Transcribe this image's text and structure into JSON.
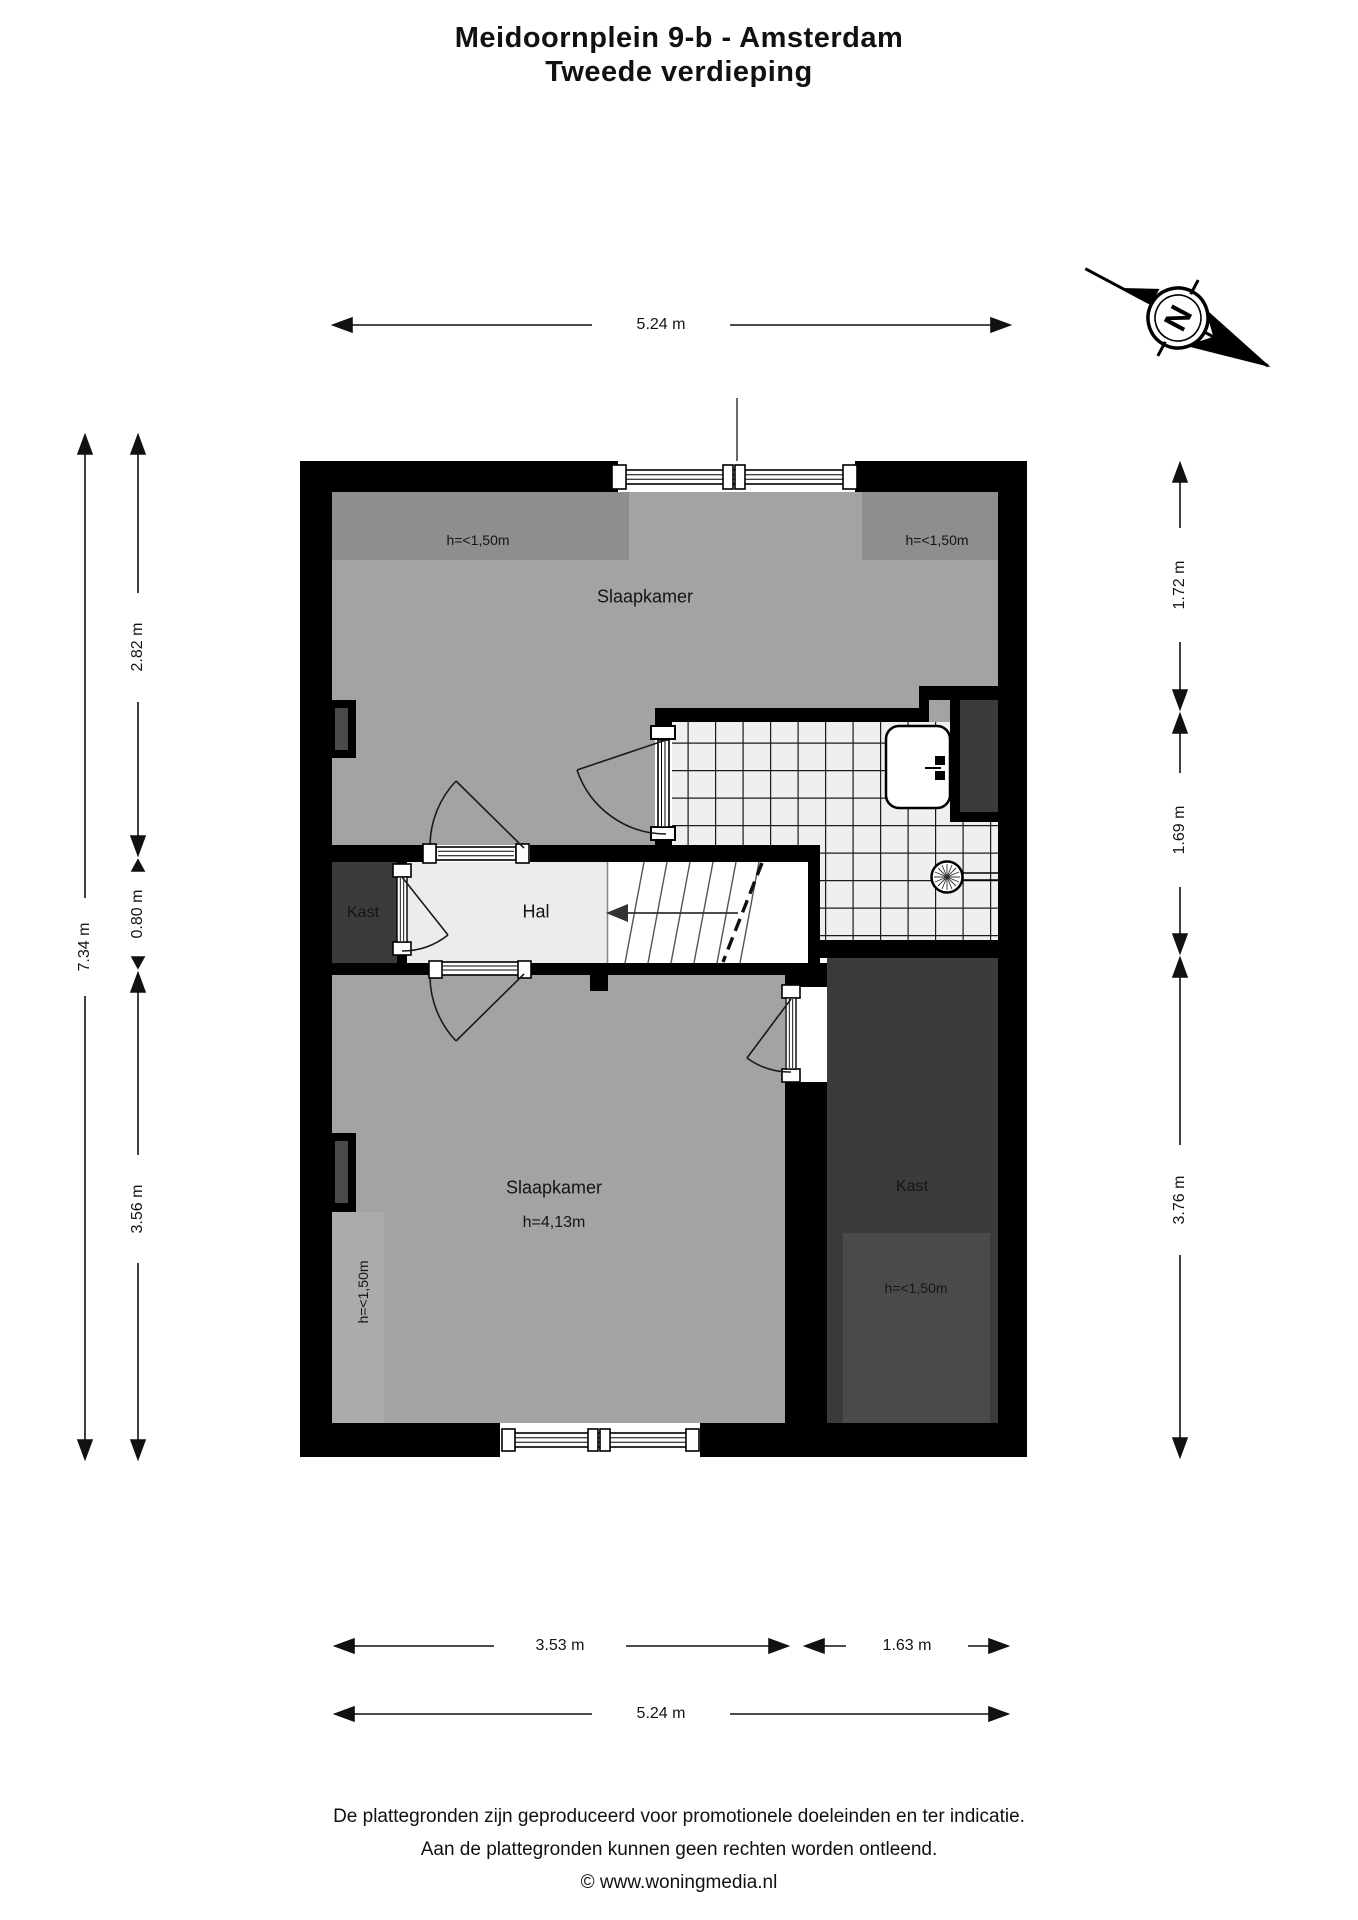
{
  "title": {
    "line1": "Meidoornplein 9-b - Amsterdam",
    "line2": "Tweede verdieping"
  },
  "compass": {
    "north_label": "N"
  },
  "plan": {
    "rooms": {
      "bedroom_top": {
        "label": "Slaapkamer",
        "low_ceiling_left": "h=<1,50m",
        "low_ceiling_right": "h=<1,50m"
      },
      "hall": {
        "label": "Hal"
      },
      "closet_left": {
        "label": "Kast"
      },
      "bedroom_bottom": {
        "label": "Slaapkamer",
        "ceiling_height": "h=4,13m",
        "low_ceiling_left": "h=<1,50m"
      },
      "closet_right": {
        "label": "Kast",
        "low_ceiling": "h=<1,50m"
      }
    }
  },
  "dimensions": {
    "top_width": "5.24 m",
    "left_total": "7.34 m",
    "left_top": "2.82 m",
    "left_middle": "0.80 m",
    "left_bottom": "3.56 m",
    "right_top": "1.72 m",
    "right_middle": "1.69 m",
    "right_bottom": "3.76 m",
    "bottom_left": "3.53 m",
    "bottom_right": "1.63 m",
    "bottom_total": "5.24 m"
  },
  "footer": {
    "line1": "De plattegronden zijn geproduceerd voor promotionele doeleinden en ter indicatie.",
    "line2": "Aan de plattegronden kunnen geen rechten worden ontleend.",
    "line3": "© www.woningmedia.nl"
  },
  "colors": {
    "wall": "#000000",
    "floor": "#a3a3a3",
    "low_ceiling_zone": "#8e8e8e",
    "closet_dark": "#3b3b3b",
    "closet_inner": "#4a4a4a",
    "hall_floor": "#ececec",
    "tile": "#efefef",
    "light_strip": "#ababab"
  }
}
